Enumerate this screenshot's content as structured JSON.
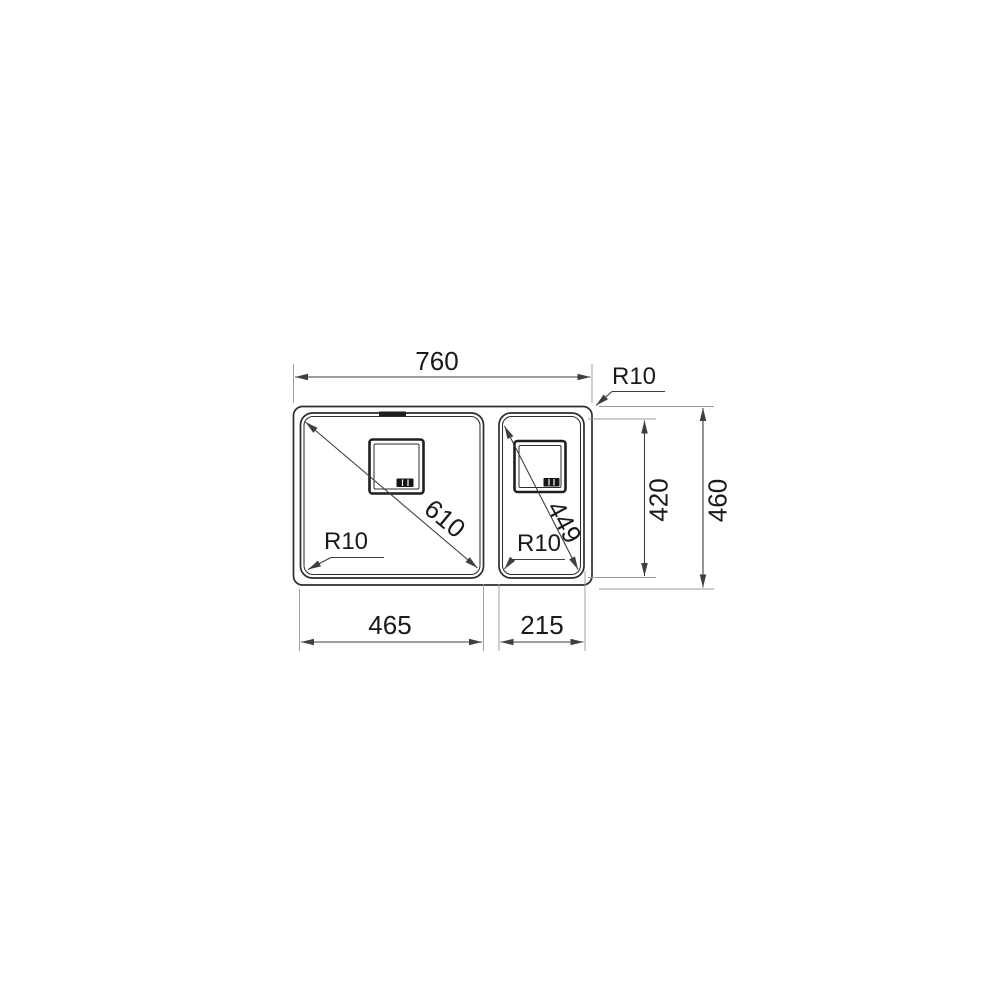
{
  "drawing": {
    "subject": "double-bowl sink top view dimension drawing",
    "dims": {
      "overall_width": "760",
      "overall_depth": "460",
      "bowl_depth": "420",
      "main_bowl_width": "465",
      "aux_bowl_width": "215",
      "main_bowl_diagonal": "610",
      "aux_bowl_diagonal": "449",
      "outer_corner_radius": "R10",
      "main_bowl_corner_radius": "R10",
      "aux_bowl_corner_radius": "R10"
    },
    "colors": {
      "outline": "#2d2d2d",
      "dimension_line": "#3f3f3f",
      "extension_line": "#9b9b9b",
      "text": "#1a1a1a",
      "background": "#ffffff"
    }
  }
}
